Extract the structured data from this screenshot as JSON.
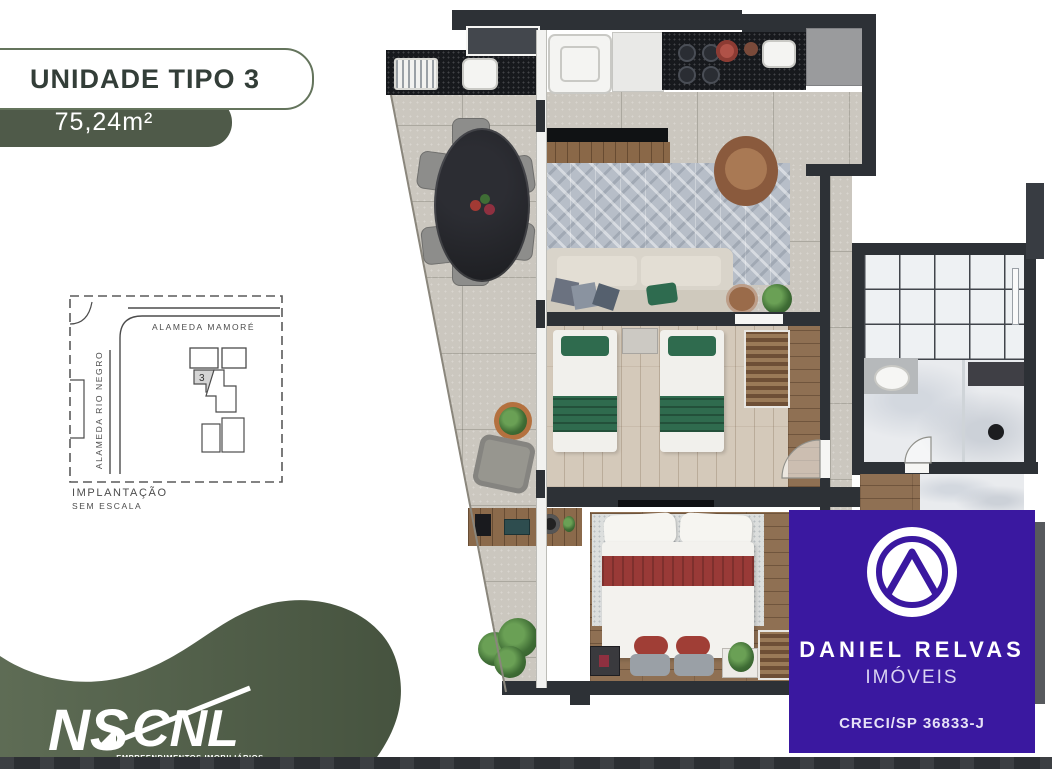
{
  "header": {
    "title": "UNIDADE TIPO 3",
    "area": "75,24m²"
  },
  "site_plan": {
    "street_top": "ALAMEDA MAMORÉ",
    "street_left": "ALAMEDA RIO NEGRO",
    "unit_number": "3",
    "caption_line1": "IMPLANTAÇÃO",
    "caption_line2": "SEM ESCALA"
  },
  "broker": {
    "name": "DANIEL RELVAS",
    "subtitle": "IMÓVEIS",
    "license": "CRECI/SP 36833-J"
  },
  "developer": {
    "logo_ns": "NS",
    "logo_cnl": "CNL",
    "caption": "EMPREENDIMENTOS IMOBILIÁRIOS"
  },
  "colors": {
    "accent_purple": "#3a18a0",
    "badge_green": "#4f5a49",
    "wave_green": "#5d6b54",
    "wall_dark": "#2d3136"
  }
}
